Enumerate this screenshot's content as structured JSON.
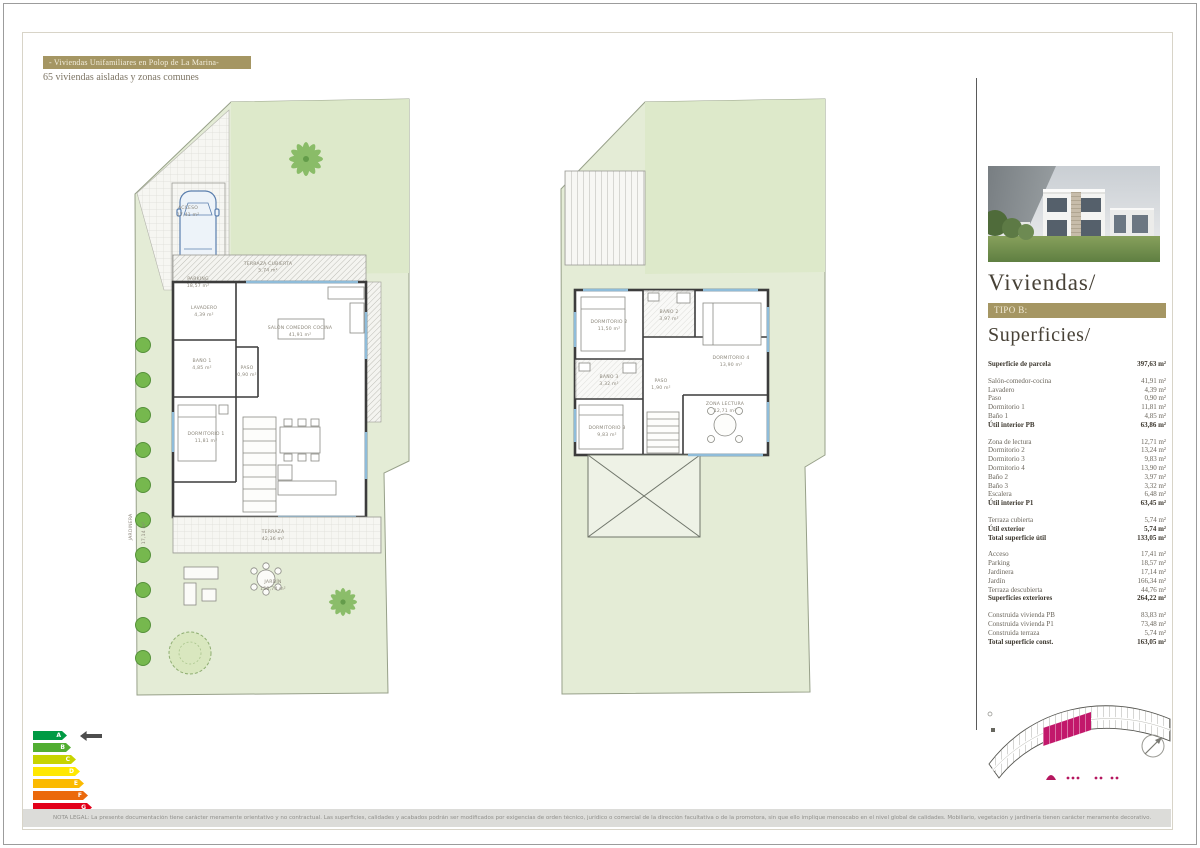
{
  "header": {
    "title": "- Viviendas Unifamiliares en Polop de La Marina-",
    "subtitle": "65 viviendas aisladas y zonas comunes"
  },
  "sidebar": {
    "section_title": "Viviendas/",
    "type_label": "TIPO B:",
    "surfaces_title": "Superficies/",
    "photo_description": "villa-render",
    "groups": [
      {
        "rows": [
          {
            "label": "Superficie de parcela",
            "value": "397,63 m²",
            "bold": true
          }
        ]
      },
      {
        "rows": [
          {
            "label": "Salón-comedor-cocina",
            "value": "41,91 m²"
          },
          {
            "label": "Lavadero",
            "value": "4,39 m²"
          },
          {
            "label": "Paso",
            "value": "0,90 m²"
          },
          {
            "label": "Dormitorio 1",
            "value": "11,81 m²"
          },
          {
            "label": "Baño 1",
            "value": "4,85 m²"
          },
          {
            "label": "Útil interior PB",
            "value": "63,86 m²",
            "bold": true
          }
        ]
      },
      {
        "rows": [
          {
            "label": "Zona de lectura",
            "value": "12,71 m²"
          },
          {
            "label": "Dormitorio 2",
            "value": "13,24 m²"
          },
          {
            "label": "Dormitorio 3",
            "value": "9,83 m²"
          },
          {
            "label": "Dormitorio 4",
            "value": "13,90 m²"
          },
          {
            "label": "Baño 2",
            "value": "3,97 m²"
          },
          {
            "label": "Baño 3",
            "value": "3,32 m²"
          },
          {
            "label": "Escalera",
            "value": "6,48 m²"
          },
          {
            "label": "Útil interior P1",
            "value": "63,45 m²",
            "bold": true
          }
        ]
      },
      {
        "rows": [
          {
            "label": "Terraza cubierta",
            "value": "5,74 m²"
          },
          {
            "label": "Útil exterior",
            "value": "5,74 m²",
            "bold": true
          },
          {
            "label": "Total superficie útil",
            "value": "133,05 m²",
            "bold": true
          }
        ]
      },
      {
        "rows": [
          {
            "label": "Acceso",
            "value": "17,41 m²"
          },
          {
            "label": "Parking",
            "value": "18,57 m²"
          },
          {
            "label": "Jardinera",
            "value": "17,14 m²"
          },
          {
            "label": "Jardín",
            "value": "166,34 m²"
          },
          {
            "label": "Terraza descubierta",
            "value": "44,76 m²"
          },
          {
            "label": "Superficies exteriores",
            "value": "264,22 m²",
            "bold": true
          }
        ]
      },
      {
        "rows": [
          {
            "label": "Construida vivienda PB",
            "value": "83,83 m²"
          },
          {
            "label": "Construida vivienda P1",
            "value": "73,48 m²"
          },
          {
            "label": "Construida terraza",
            "value": "5,74 m²"
          },
          {
            "label": "Total superficie const.",
            "value": "163,05 m²",
            "bold": true
          }
        ]
      }
    ]
  },
  "plans": {
    "ground": {
      "rooms": {
        "terraza_cubierta": {
          "name": "TERRAZA CUBIERTA",
          "value": "5,74 m²"
        },
        "lavadero": {
          "name": "LAVADERO",
          "value": "4,39 m²"
        },
        "bano1": {
          "name": "BAÑO 1",
          "value": "4,85 m²"
        },
        "paso": {
          "name": "PASO",
          "value": "0,90 m²"
        },
        "salon": {
          "name": "SALÓN COMEDOR COCINA",
          "value": "41,91 m²"
        },
        "dormitorio1": {
          "name": "DORMITORIO 1",
          "value": "11,81 m²"
        },
        "terraza": {
          "name": "TERRAZA",
          "value": "42,36 m²"
        },
        "jardin": {
          "name": "JARDÍN",
          "value": "150,74 m²"
        },
        "jardinera": {
          "name": "JARDINERA",
          "value": "17,14 m²"
        },
        "acceso": {
          "name": "ACCESO",
          "value": "17,41 m²"
        },
        "parking": {
          "name": "PARKING",
          "value": "18,57 m²"
        }
      }
    },
    "first": {
      "rooms": {
        "dormitorio2": {
          "name": "DORMITORIO 2",
          "value": "11,50 m²"
        },
        "bano2": {
          "name": "BAÑO 2",
          "value": "3,97 m²"
        },
        "dormitorio4": {
          "name": "DORMITORIO 4",
          "value": "13,90 m²"
        },
        "bano3": {
          "name": "BAÑO 3",
          "value": "3,32 m²"
        },
        "paso": {
          "name": "PASO",
          "value": "1,90 m²"
        },
        "dormitorio3": {
          "name": "DORMITORIO 3",
          "value": "9,83 m²"
        },
        "zona_lectura": {
          "name": "ZONA LECTURA",
          "value": "12,71 m²"
        }
      }
    }
  },
  "energy_label": {
    "levels": [
      {
        "letter": "A",
        "color": "#009a44"
      },
      {
        "letter": "B",
        "color": "#52ae32"
      },
      {
        "letter": "C",
        "color": "#c8d400"
      },
      {
        "letter": "D",
        "color": "#ffe800"
      },
      {
        "letter": "E",
        "color": "#fbba00"
      },
      {
        "letter": "F",
        "color": "#eb690b"
      },
      {
        "letter": "G",
        "color": "#e2001a"
      }
    ],
    "pointer_level": "A",
    "pointer_color": "#4d4d4d"
  },
  "site_plan": {
    "highlight_color": "#c2186b"
  },
  "footer": {
    "disclaimer": "NOTA LEGAL: La presente documentación tiene carácter meramente orientativo y no contractual. Las superficies, calidades y acabados podrán ser modificados por exigencias de orden técnico, jurídico o comercial de la dirección facultativa o de la promotora, sin que ello implique menoscabo en el nivel global de calidades. Mobiliario, vegetación y jardinería tienen carácter meramente decorativo."
  }
}
